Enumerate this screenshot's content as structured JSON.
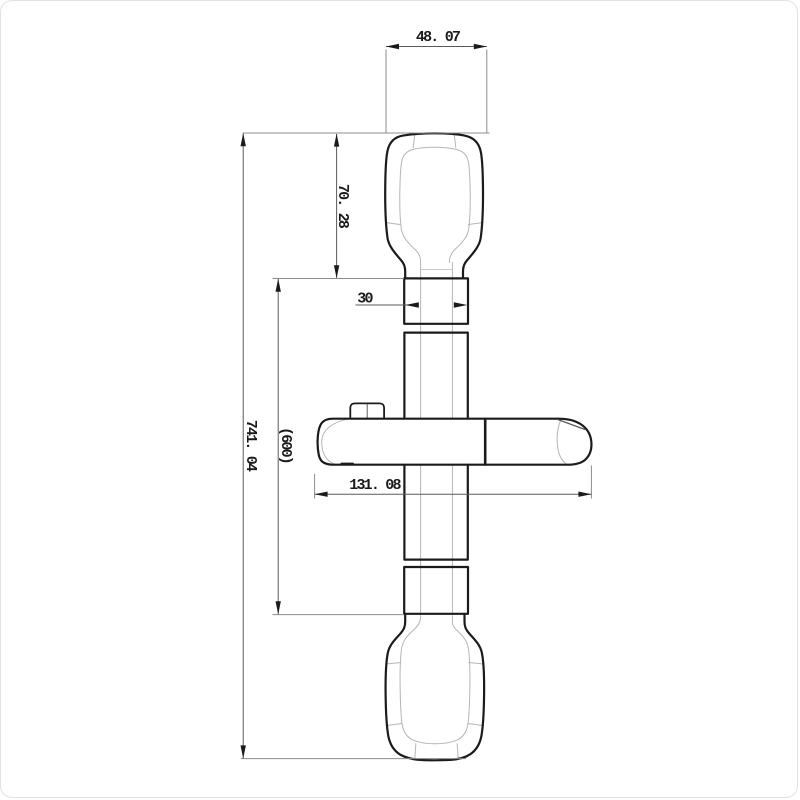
{
  "page": {
    "background": "#ffffff",
    "border_color": "#e2e2e2"
  },
  "drawing": {
    "title": "Shower slide bar - dimensioned front view",
    "outline_color": "#1b1b1b",
    "thin_line_color": "#b5b5b5",
    "dimension_line_color": "#5a5a5a",
    "text_color": "#1a1a1a",
    "dimensions": {
      "top_width": "48. 07",
      "top_bracket_height": "70. 28",
      "bar_section_width": "30",
      "slider_length": "131. 08",
      "rail_length": "(600)",
      "overall_length": "741. 04"
    }
  }
}
